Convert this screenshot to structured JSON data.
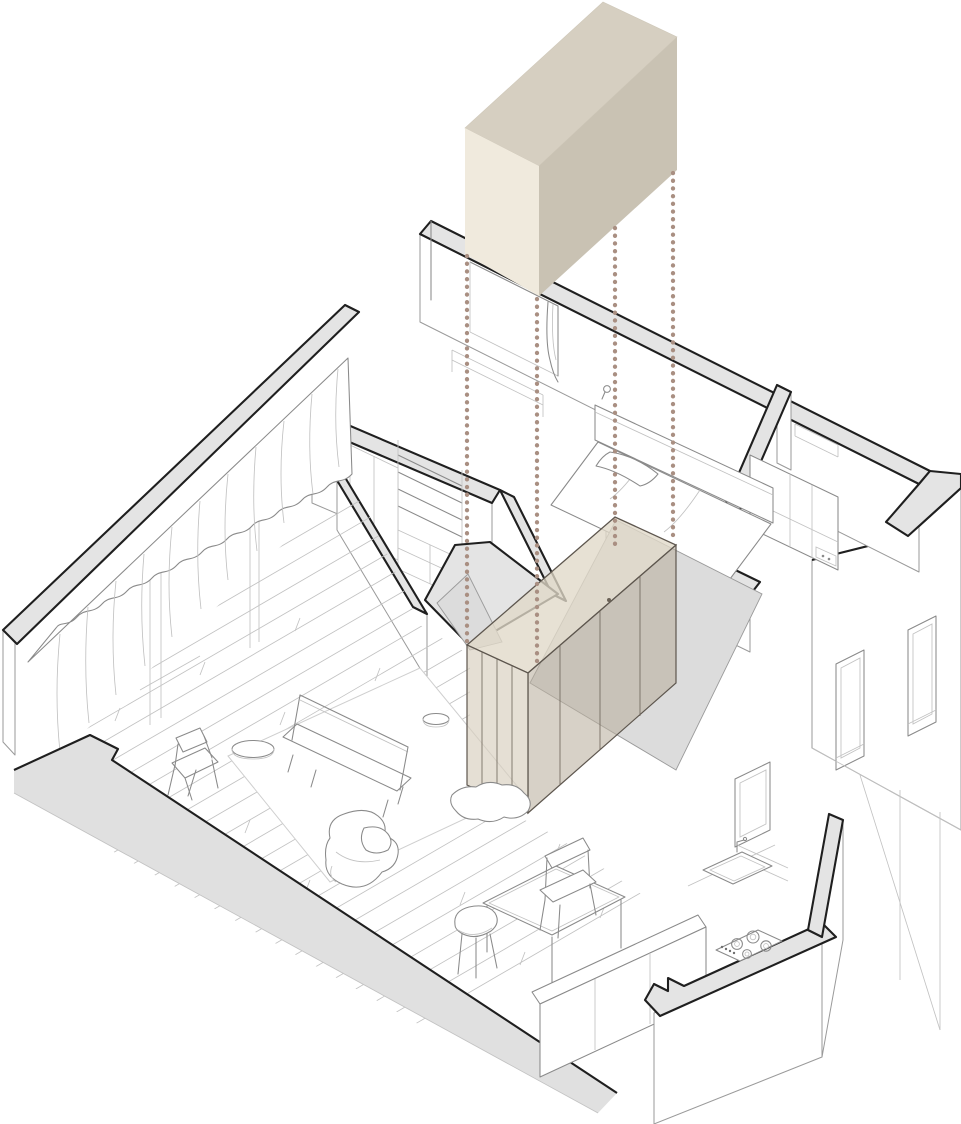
{
  "page": {
    "title": "Apartment axonometric exploded diagram"
  },
  "colors": {
    "background": "#ffffff",
    "wall_fill": "#e4e4e4",
    "wall_outline": "#1f1f1f",
    "line_medium": "#8a8a8a",
    "line_fine": "#c2c2c2",
    "floor_gray": "#dcdcdc",
    "box_top": "#d6cfc1",
    "box_front": "#f0eadd",
    "box_side": "#c9c2b3",
    "volume_top": "rgba(224,216,200,0.78)",
    "volume_front": "rgba(216,207,189,0.66)",
    "volume_side": "rgba(186,176,158,0.58)",
    "volume_edge": "#5d564e",
    "projection_dot": "#a98f82"
  },
  "diagram": {
    "type": "axonometric-exploded-floor-plan",
    "floating_volume": {
      "name": "extracted-storage-volume",
      "faces": [
        "top",
        "front",
        "side"
      ]
    },
    "projection_lines": {
      "count": 4,
      "style": "dotted-vertical"
    },
    "inserted_volume": {
      "name": "wardrobe-storage-volume",
      "translucent": true,
      "door_panels": 4
    },
    "rooms": [
      {
        "name": "living-room",
        "floor": "wood-planks",
        "furniture": [
          "bench-sofa",
          "armchair",
          "round-side-table",
          "stool",
          "lounge-chair",
          "rug",
          "dining-table",
          "dining-chair-round",
          "dining-chair-arm",
          "kitchen-counter"
        ]
      },
      {
        "name": "bedroom",
        "furniture": [
          "double-bed",
          "pillow",
          "duvet-drape",
          "window-curtain",
          "radiator",
          "wall-sconce"
        ]
      },
      {
        "name": "study-closet",
        "furniture": [
          "shelving-unit",
          "tall-cabinet",
          "low-cabinet"
        ]
      },
      {
        "name": "bathroom-laundry",
        "furniture": [
          "tall-cabinet",
          "control-panel"
        ]
      },
      {
        "name": "kitchen",
        "furniture": [
          "sink",
          "faucet",
          "gas-cooktop",
          "window",
          "shelves"
        ]
      },
      {
        "name": "hallway",
        "floor": "gray"
      }
    ],
    "windows": {
      "east_wall": 2,
      "kitchen": 1,
      "bedroom": 1,
      "living_room": "full-height glazing with curtains"
    }
  }
}
